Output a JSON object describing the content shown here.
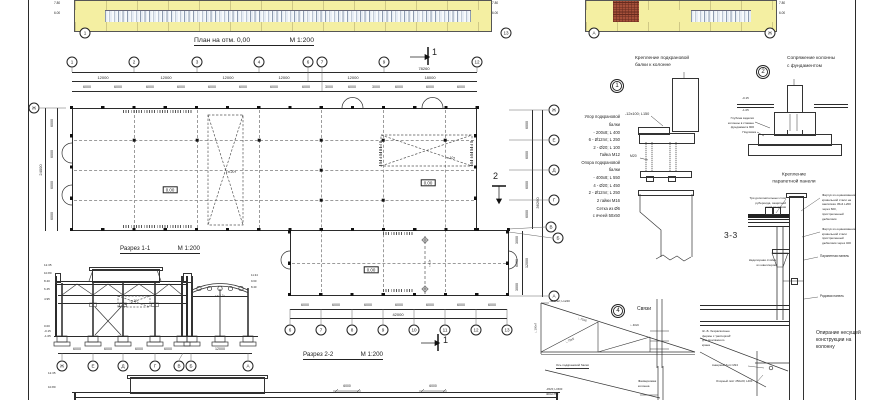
{
  "sheet": {
    "bg": "#ffffff",
    "line_color": "#2b2b2b",
    "accent_yellow": "#f4efa2"
  },
  "facade_main": {
    "axis_left": "1",
    "axis_right": "13",
    "marks_left": [
      "7.80",
      "6.00"
    ],
    "marks_right": [
      "7.80",
      "6.00"
    ]
  },
  "facade_side": {
    "axis_left": "А",
    "axis_right": "Ж",
    "marks_right": [
      "7.80",
      "6.00"
    ]
  },
  "plan": {
    "title": "План на отм. 0,00",
    "scale": "М 1:200",
    "total_top": "78260",
    "dims_row1": [
      "12000",
      "12000",
      "12000",
      "12000",
      "12000",
      "18000"
    ],
    "dims_row2": [
      "6000",
      "6000",
      "6000",
      "6000",
      "6000",
      "6000",
      "6000",
      "6000",
      "3000",
      "6000",
      "3000",
      "6000",
      "6000",
      "6000"
    ],
    "axes_top": [
      "1",
      "2",
      "3",
      "4",
      "6",
      "7",
      "9",
      "12"
    ],
    "axes_bottom": [
      "6",
      "7",
      "8",
      "9",
      "10",
      "11",
      "12",
      "13"
    ],
    "axes_right": [
      "Ж",
      "Е",
      "Д",
      "Г",
      "В",
      "Б",
      "А"
    ],
    "axis_left": "Ж",
    "dims_left": [
      "6000",
      "6000",
      "6000",
      "6000"
    ],
    "total_left": "24000",
    "dims_right_upper": [
      "6000",
      "6000",
      "6000",
      "6000"
    ],
    "total_right": "36260",
    "dims_right_lower": [
      "3000",
      "6000",
      "3000"
    ],
    "total_right_lower": "12000",
    "dims_bottom": [
      "6000",
      "6000",
      "6000",
      "6000",
      "6000",
      "6000",
      "6000"
    ],
    "total_bottom": "42000",
    "level": "0.00",
    "crane_20": "г.п.20т",
    "crane_10": "г.п.10т",
    "crane_2": "г.п.2т",
    "sec1": "1",
    "sec2": "2"
  },
  "section1": {
    "title": "Разрез 1-1",
    "scale": "М 1:200",
    "elevations": [
      "12.35",
      "10.80",
      "8.40",
      "6.45",
      "4.95",
      "0.00",
      "-0.15",
      "-1.05"
    ],
    "annex_marks": [
      "11.34",
      "9.60",
      "8.40"
    ],
    "crane": "г.п.20т",
    "annex_crane": "г.п.3,2т",
    "dims": [
      "6000",
      "6000",
      "6000",
      "6000",
      "12000"
    ],
    "axes": [
      "Ж",
      "Е",
      "Д",
      "Г",
      "В",
      "Б",
      "А"
    ]
  },
  "section2": {
    "title": "Разрез 2-2",
    "scale": "М 1:200",
    "elevations": [
      "12.35",
      "10.80"
    ],
    "dims": [
      "6000",
      "6000"
    ]
  },
  "detail1": {
    "num": "1",
    "title": [
      "Крепление подкрановой",
      "балки к колонне"
    ],
    "specs": [
      "Упор подкрановой",
      "балки",
      "- 200х8; L 400",
      "6 - Ø12пл; L 250",
      "2 - Ø20; L 100",
      "Гайка М12",
      "Опора подкрановой",
      "балки",
      "- 400х8; L 550",
      "4 - Ø20; L 450",
      "2 - Ø12пл; L 250",
      "2 гайки М16",
      "Сетка из Ø6",
      "с ячеей 50х50"
    ],
    "callout": "-12х100; L150",
    "bolt": "М20"
  },
  "detail2": {
    "num": "2",
    "title": [
      "Сопряжение колонны",
      "с фундаментом"
    ],
    "marks": [
      "-0.15",
      "-1.05"
    ],
    "note": [
      "Глубина заделки",
      "колонны в стакане",
      "фундамента 900"
    ],
    "grout": "Подливка"
  },
  "parapet_detail": {
    "title": [
      "Крепление",
      "парапетной панели"
    ]
  },
  "detail33": {
    "label": "3-3",
    "roof_note": [
      "Три дополнительных слоя",
      "рубероида, защитный",
      "слой из гравия"
    ],
    "apron1": [
      "Фартук из оцинкованной",
      "кровельной стали на",
      "заклёпках 45х4 L200",
      "через 600,",
      "пристреленный",
      "дюбелями"
    ],
    "apron2": [
      "Фартук из оцинкованной",
      "кровельной стали",
      "пристреленный",
      "дюбелями через 400"
    ],
    "parapet_panel": "Парапетная панель",
    "post": [
      "Надопорная стойка",
      "из швеллеров"
    ],
    "row_panel": "Рядовая панель",
    "truss_note": [
      "Ж.-Б. безраскосные",
      "фермы с 'распоркой'",
      "для монтажного",
      "крана"
    ],
    "anchor": "Анкерный болт М24",
    "plate": "Опорный лист 250х20; L400"
  },
  "support_note": {
    "title": [
      "Опирание несущей",
      "конструкции на",
      "колонну"
    ]
  },
  "detail4": {
    "num": "4",
    "title": "Связи",
    "labels": {
      "plate": "-400х12; L1240",
      "angle1": "∟75х6",
      "angle2": "∟75х5",
      "angle3": "∟40х6",
      "edge": "∟100х7",
      "axis": "Ось подкрановой балки",
      "col": [
        "Фахверковая",
        "колонна"
      ],
      "b1": "-45х5; L1500",
      "b2": "400х1750"
    }
  }
}
